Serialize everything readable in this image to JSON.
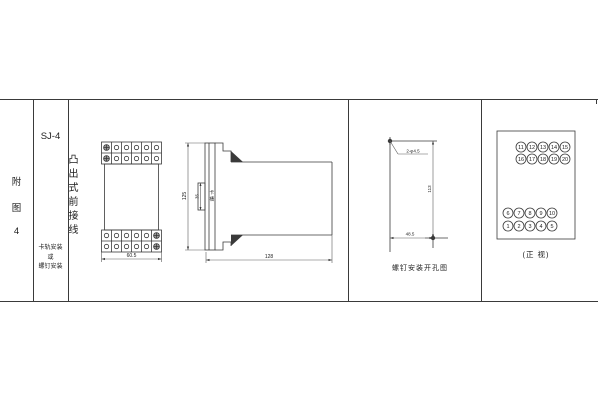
{
  "sheet": {
    "figure_label_chars": [
      "附",
      "图",
      "4"
    ],
    "model": "SJ-4",
    "type_label": "凸出式前接线",
    "mounting_lines": [
      "卡轨安装",
      "或",
      "螺钉安装"
    ]
  },
  "front_view": {
    "width_dim": "60.5"
  },
  "side_view": {
    "height_dim": "125",
    "depth_dim": "128",
    "slot_dim": "35",
    "slot_label_chars": [
      "卡",
      "槽"
    ]
  },
  "drill_view": {
    "holes_label": "2-φ4.5",
    "height_dim": "113",
    "width_dim": "48.5",
    "caption": "螺钉安装开孔图"
  },
  "terminal_view": {
    "caption": "(正 视)",
    "top_rows": [
      [
        "11",
        "12",
        "13",
        "14",
        "15"
      ],
      [
        "16",
        "17",
        "18",
        "19",
        "20"
      ]
    ],
    "bottom_rows": [
      [
        "6",
        "7",
        "8",
        "9",
        "10"
      ],
      [
        "1",
        "2",
        "3",
        "4",
        "5"
      ]
    ]
  },
  "colors": {
    "line": "#3a3a3a",
    "text": "#1c1c1c"
  }
}
